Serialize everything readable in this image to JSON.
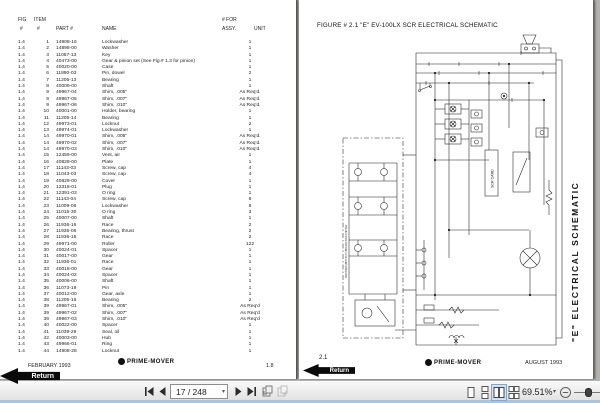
{
  "left_page": {
    "header": {
      "fig": "FIG",
      "item": "ITEM",
      "num1": "#",
      "num2": "#",
      "part": "PART #",
      "name": "NAME",
      "for1": "# FOR",
      "for2": "ASSY.",
      "unit": "UNIT"
    },
    "rows": [
      [
        "1.4",
        "1",
        "14908-16",
        "Lockwasher",
        "1"
      ],
      [
        "1.4",
        "2",
        "14898-00",
        "Washer",
        "1"
      ],
      [
        "1.4",
        "3",
        "11057-13",
        "Key",
        "1"
      ],
      [
        "1.4",
        "4",
        "40473-00",
        "Gear & pinion set (See Fig.# 1.3 for pinion)",
        "1"
      ],
      [
        "1.4",
        "5",
        "40020-00",
        "Case",
        "1"
      ],
      [
        "1.4",
        "6",
        "11890-03",
        "Pin, dowel",
        "2"
      ],
      [
        "1.4",
        "7",
        "11205-13",
        "Bearing",
        "1"
      ],
      [
        "1.4",
        "8",
        "40009-00",
        "Shaft",
        "1"
      ],
      [
        "1.4",
        "9",
        "49967-04",
        "Shim, .005\"",
        "As Req'd."
      ],
      [
        "1.4",
        "9",
        "49967-05",
        "Shim, .007\"",
        "As Req'd."
      ],
      [
        "1.4",
        "9",
        "49967-06",
        "Shim, .010\"",
        "As Req'd."
      ],
      [
        "1.4",
        "10",
        "40001-00",
        "Holder, bearing",
        "1"
      ],
      [
        "1.4",
        "11",
        "11205-14",
        "Bearing",
        "1"
      ],
      [
        "1.4",
        "12",
        "49973-01",
        "Locknut",
        "2"
      ],
      [
        "1.4",
        "13",
        "49974-01",
        "Lockwasher",
        "1"
      ],
      [
        "1.4",
        "14",
        "49970-01",
        "Shim, .005\"",
        "As Req'd."
      ],
      [
        "1.4",
        "14",
        "49970-02",
        "Shim, .007\"",
        "As Req'd."
      ],
      [
        "1.4",
        "14",
        "49970-03",
        "Shim, .010\"",
        "As Req'd."
      ],
      [
        "1.4",
        "15",
        "12459-00",
        "Vent, air",
        "1"
      ],
      [
        "1.4",
        "16",
        "40828-00",
        "Plate",
        "1"
      ],
      [
        "1.4",
        "17",
        "11143-03",
        "Screw, cap",
        "4"
      ],
      [
        "1.4",
        "18",
        "11043-03",
        "Screw, cap",
        "4"
      ],
      [
        "1.4",
        "19",
        "40829-00",
        "Cover",
        "1"
      ],
      [
        "1.4",
        "20",
        "12318-01",
        "Plug",
        "1"
      ],
      [
        "1.4",
        "21",
        "12391-03",
        "O ring",
        "1"
      ],
      [
        "1.4",
        "22",
        "11143-04",
        "Screw, cap",
        "8"
      ],
      [
        "1.4",
        "23",
        "11009-06",
        "Lockwasher",
        "8"
      ],
      [
        "1.4",
        "24",
        "11015-30",
        "O ring",
        "3"
      ],
      [
        "1.4",
        "25",
        "40007-00",
        "Shaft",
        "1"
      ],
      [
        "1.4",
        "26",
        "11936-16",
        "Race",
        "2"
      ],
      [
        "1.4",
        "27",
        "11935-06",
        "Bearing, thrust",
        "2"
      ],
      [
        "1.4",
        "28",
        "11936-15",
        "Race",
        "2"
      ],
      [
        "1.4",
        "29",
        "49971-00",
        "Roller",
        "122"
      ],
      [
        "1.4",
        "30",
        "40024-01",
        "Spacer",
        "1"
      ],
      [
        "1.4",
        "31",
        "40017-00",
        "Gear",
        "1"
      ],
      [
        "1.4",
        "32",
        "11936-01",
        "Race",
        "1"
      ],
      [
        "1.4",
        "33",
        "40018-00",
        "Gear",
        "1"
      ],
      [
        "1.4",
        "34",
        "40024-02",
        "Spacer",
        "1"
      ],
      [
        "1.4",
        "35",
        "40006-00",
        "Shaft",
        "1"
      ],
      [
        "1.4",
        "36",
        "11073-19",
        "Pin",
        "1"
      ],
      [
        "1.4",
        "37",
        "40012-00",
        "Gear, axle",
        "1"
      ],
      [
        "1.4",
        "38",
        "11205-16",
        "Bearing",
        "2"
      ],
      [
        "1.4",
        "39",
        "49967-01",
        "Shim, .005\"",
        "As Req'd"
      ],
      [
        "1.4",
        "39",
        "49967-02",
        "Shim, .007\"",
        "As Req'd"
      ],
      [
        "1.4",
        "39",
        "49967-03",
        "Shim, .010\"",
        "As Req'd"
      ],
      [
        "1.4",
        "40",
        "40022-00",
        "Spacer",
        "1"
      ],
      [
        "1.4",
        "41",
        "11039-29",
        "Seal, oil",
        "1"
      ],
      [
        "1.4",
        "42",
        "40003-00",
        "Hub",
        "1"
      ],
      [
        "1.4",
        "43",
        "49966-01",
        "Ring",
        "1"
      ],
      [
        "1.4",
        "44",
        "14908-28",
        "Locknut",
        "1"
      ]
    ],
    "footer": {
      "date": "FEBRUARY 1993",
      "brand": "PRIME-MOVER",
      "page": "1.8"
    },
    "return_label": "Return"
  },
  "right_page": {
    "title": "FIGURE # 2.1  \"E\" EV-100LX SCR ELECTRICAL SCHEMATIC",
    "vertical_label": "\"E\"  ELECTRICAL  SCHEMATIC",
    "scr_card_label": "SCR CARD",
    "side_note": "MACHINES WITH TILT FWD AND TIER SHIFTER",
    "footer": {
      "brand": "PRIME-MOVER",
      "date": "AUGUST 1993",
      "page": "2.1"
    },
    "return_label": "Return"
  },
  "viewer": {
    "toolbar": {
      "page_field": "17 / 248",
      "zoom_level": "69.51%",
      "caret_glyph": "▾",
      "colors": {
        "view_selected_bg": "#cfe3f5",
        "view_selected_border": "#86a7c8",
        "bottom_strip": "#a9c4dc"
      }
    }
  }
}
